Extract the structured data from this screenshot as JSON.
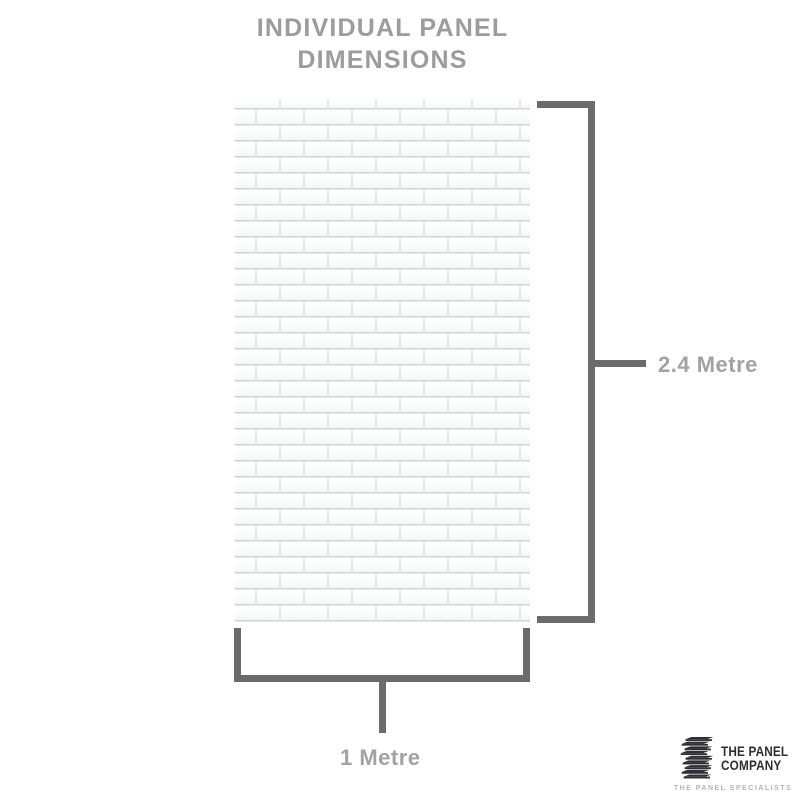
{
  "title": {
    "line1": "INDIVIDUAL PANEL",
    "line2": "DIMENSIONS"
  },
  "panel": {
    "texture": "white-subway-tile-brick-pattern",
    "height_label": "2.4 Metre",
    "width_label": "1 Metre"
  },
  "logo": {
    "icon": "stacked-panels-icon",
    "name_line1": "THE PANEL",
    "name_line2": "COMPANY",
    "tagline": "THE PANEL SPECIALISTS"
  },
  "colors": {
    "background": "#ffffff",
    "title_gray": "#9c9c9c",
    "dimension_line_gray": "#6b6b6b",
    "dimension_label_gray": "#a2a2a2",
    "grout_gray": "#e9ebec",
    "tile_white": "#fcfdfd",
    "logo_dark": "#2e2e33",
    "tagline_gray": "#b4b4b4"
  }
}
